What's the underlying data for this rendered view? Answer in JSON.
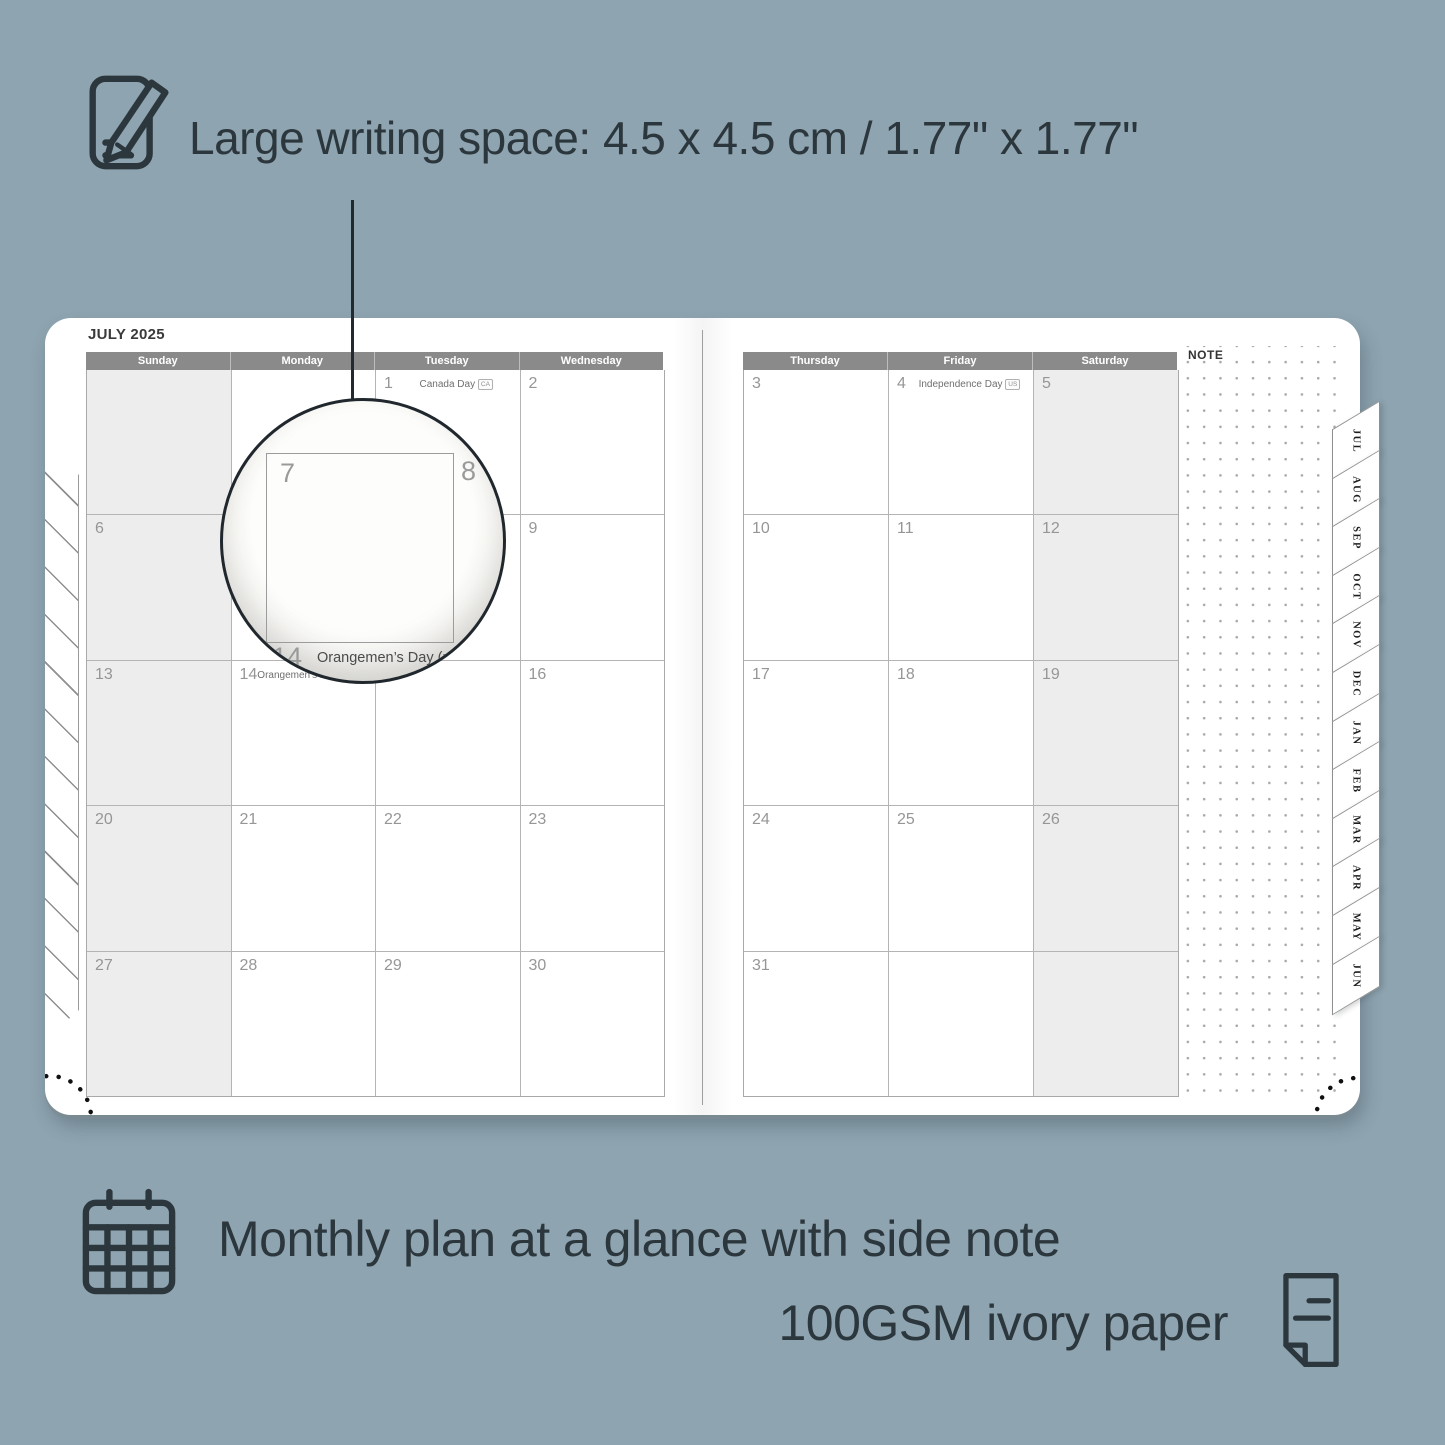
{
  "colors": {
    "background": "#8EA4B0",
    "ink": "#2C373D",
    "page": "#FFFFFF",
    "header_bar": "#8A8A8A",
    "grid_line": "#B4B4B4",
    "shaded_cell": "#EDEDED",
    "date_number": "#969696"
  },
  "annotations": {
    "top_text": "Large writing space: 4.5 x 4.5 cm / 1.77\" x 1.77\"",
    "bottom_text_1": "Monthly plan at a glance with side note",
    "bottom_text_2": "100GSM ivory paper"
  },
  "planner": {
    "month_title": "JULY 2025",
    "note_label": "NOTE",
    "left_day_headers": [
      "Sunday",
      "Monday",
      "Tuesday",
      "Wednesday"
    ],
    "right_day_headers": [
      "Thursday",
      "Friday",
      "Saturday"
    ],
    "left_weeks": [
      [
        {
          "day": "",
          "shaded": true
        },
        {
          "day": ""
        },
        {
          "day": "1",
          "holiday": "Canada Day",
          "badge": "CA"
        },
        {
          "day": "2"
        }
      ],
      [
        {
          "day": "6",
          "shaded": true
        },
        {
          "day": "7"
        },
        {
          "day": "8"
        },
        {
          "day": "9"
        }
      ],
      [
        {
          "day": "13",
          "shaded": true
        },
        {
          "day": "14",
          "holiday": "Orangemen’s Day (n.i.)",
          "badge": "UK"
        },
        {
          "day": "15"
        },
        {
          "day": "16"
        }
      ],
      [
        {
          "day": "20",
          "shaded": true
        },
        {
          "day": "21"
        },
        {
          "day": "22"
        },
        {
          "day": "23"
        }
      ],
      [
        {
          "day": "27",
          "shaded": true
        },
        {
          "day": "28"
        },
        {
          "day": "29"
        },
        {
          "day": "30"
        }
      ]
    ],
    "right_weeks": [
      [
        {
          "day": "3"
        },
        {
          "day": "4",
          "holiday": "Independence Day",
          "badge": "US"
        },
        {
          "day": "5",
          "shaded": true
        }
      ],
      [
        {
          "day": "10"
        },
        {
          "day": "11"
        },
        {
          "day": "12",
          "shaded": true
        }
      ],
      [
        {
          "day": "17"
        },
        {
          "day": "18"
        },
        {
          "day": "19",
          "shaded": true
        }
      ],
      [
        {
          "day": "24"
        },
        {
          "day": "25"
        },
        {
          "day": "26",
          "shaded": true
        }
      ],
      [
        {
          "day": "31"
        },
        {
          "day": ""
        },
        {
          "day": "",
          "shaded": true
        }
      ]
    ],
    "month_tabs": [
      "JUL",
      "AUG",
      "SEP",
      "OCT",
      "NOV",
      "DEC",
      "JAN",
      "FEB",
      "MAR",
      "APR",
      "MAY",
      "JUN"
    ],
    "magnifier": {
      "top_left_day": "7",
      "top_right_day": "8",
      "bottom_left_day": "14",
      "bottom_right_day": "15",
      "holiday_label": "Orangemen’s Day (n.i.)",
      "holiday_badge": "UK"
    }
  }
}
